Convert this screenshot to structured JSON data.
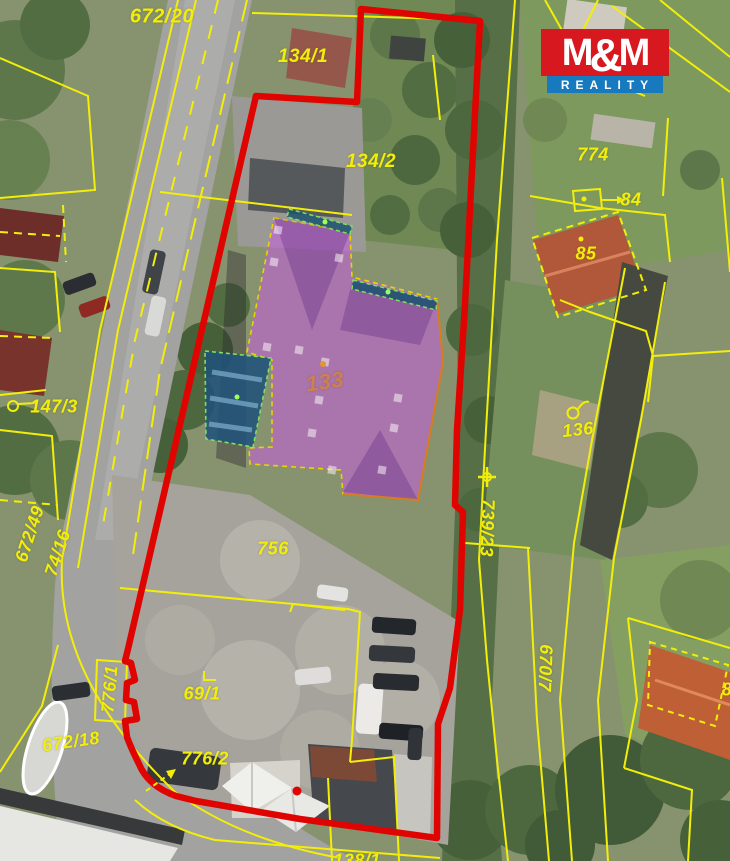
{
  "logo": {
    "m1": "M",
    "amp": "&",
    "m2": "M",
    "reality": "REALITY",
    "red": "#d7191f",
    "blue": "#1779be"
  },
  "map": {
    "colors": {
      "boundary_red": "#df0400",
      "cadastral_yellow": "#f2ee0a",
      "highlight_purple_fill": "rgba(199,92,224,0.55)",
      "highlight_purple_edge": "#e9d400",
      "highlight_orange_edge": "#d97b20",
      "terrace_fill": "rgba(26,84,112,0.85)",
      "terrace_edge": "#7fe060",
      "blue_building_fill": "rgba(32,82,122,0.88)",
      "label_orange": "#cf8050"
    },
    "parcel_labels": [
      {
        "id": "672-20",
        "text": "672/20",
        "x": 162,
        "y": 17,
        "rot": 0,
        "size": 20
      },
      {
        "id": "134-1",
        "text": "134/1",
        "x": 303,
        "y": 57,
        "rot": 0,
        "size": 19
      },
      {
        "id": "134-2",
        "text": "134/2",
        "x": 371,
        "y": 162,
        "rot": 0,
        "size": 19
      },
      {
        "id": "774",
        "text": "774",
        "x": 593,
        "y": 155,
        "rot": 0
      },
      {
        "id": "84",
        "text": "84",
        "x": 631,
        "y": 200,
        "rot": 0
      },
      {
        "id": "85",
        "text": "85",
        "x": 586,
        "y": 254,
        "rot": 0
      },
      {
        "id": "147-3",
        "text": "147/3",
        "x": 54,
        "y": 407,
        "rot": 0
      },
      {
        "id": "133",
        "text": "133",
        "x": 325,
        "y": 382,
        "rot": -8,
        "color": "#cf8050",
        "size": 22
      },
      {
        "id": "136",
        "text": "136",
        "x": 578,
        "y": 430,
        "rot": -6
      },
      {
        "id": "739-23",
        "text": "739/23",
        "x": 487,
        "y": 528,
        "rot": 92
      },
      {
        "id": "756",
        "text": "756",
        "x": 273,
        "y": 549,
        "rot": 0
      },
      {
        "id": "672-49",
        "text": "672/49",
        "x": 30,
        "y": 534,
        "rot": -72
      },
      {
        "id": "74-16",
        "text": "74/16",
        "x": 58,
        "y": 553,
        "rot": -72
      },
      {
        "id": "776-1",
        "text": "776/1",
        "x": 110,
        "y": 689,
        "rot": -85
      },
      {
        "id": "69-1",
        "text": "69/1",
        "x": 202,
        "y": 694,
        "rot": 0
      },
      {
        "id": "672-18",
        "text": "672/18",
        "x": 71,
        "y": 742,
        "rot": -8
      },
      {
        "id": "776-2",
        "text": "776/2",
        "x": 205,
        "y": 759,
        "rot": 0
      },
      {
        "id": "670-7",
        "text": "670/7",
        "x": 545,
        "y": 668,
        "rot": 92
      },
      {
        "id": "8-partial",
        "text": "8",
        "x": 727,
        "y": 690,
        "rot": 0
      },
      {
        "id": "138-1",
        "text": "138/1",
        "x": 357,
        "y": 861,
        "rot": 0
      }
    ],
    "highlights": {
      "main_building": {
        "points": "274,218 350,232 352,277 437,299 443,362 418,500 343,494 341,470 250,464 249,448 272,447 272,360 247,352",
        "orange_edge": "M437,299 L443,362 L418,500 L343,494",
        "facets": [
          "274,218 350,232 312,330",
          "352,282 437,301 420,345 340,330",
          "343,492 418,500 380,430"
        ],
        "dormers": [
          [
            278,
            230
          ],
          [
            274,
            262
          ],
          [
            339,
            258
          ],
          [
            267,
            347
          ],
          [
            299,
            350
          ],
          [
            325,
            362
          ],
          [
            319,
            400
          ],
          [
            398,
            398
          ],
          [
            394,
            428
          ],
          [
            312,
            433
          ],
          [
            382,
            470
          ],
          [
            332,
            470
          ]
        ]
      },
      "terraces": [
        "289,209 352,226 350,234 287,217",
        "353,280 437,301 436,310 352,289"
      ],
      "blue_building": {
        "points": "205,351 271,358 253,447 206,439",
        "stripes": [
          "M212,372 L262,380",
          "M210,398 L258,406",
          "M209,424 L252,430"
        ]
      }
    },
    "boundary": {
      "path": "M361,9 L480,21 L472,170 L465,305 L457,430 L455,505 L463,512 L460,610 L450,688 L438,724 L437,838 L300,819 L196,801 L176,796 Q148,786 139,764 Q131,748 127,737 L125,721 L137,719 L134,702 L126,700 L127,683 L135,680 L131,663 L125,661 L128,649 L256,96 L357,102 Z",
      "width": 6.5
    },
    "cadastral_lines": [
      {
        "d": "M0,58 L88,96 L95,190 L0,198"
      },
      {
        "d": "M0,232 L60,236",
        "dash": "8 6"
      },
      {
        "d": "M63,205 L66,262",
        "dash": "8 6"
      },
      {
        "d": "M0,268 L55,272 L60,332"
      },
      {
        "d": "M0,336 L52,338",
        "dash": "8 6"
      },
      {
        "d": "M0,395 L46,390"
      },
      {
        "d": "M0,430 L52,436 L58,520"
      },
      {
        "d": "M0,500 L58,505",
        "dash": "8 6"
      },
      {
        "d": "M178,0 L100,330 L62,560"
      },
      {
        "d": "M196,0 L118,330 L78,568"
      },
      {
        "d": "M218,0 L135,340 L103,525",
        "dash": "14 12"
      },
      {
        "d": "M247,0 L160,370 L133,555",
        "dash": "22 10"
      },
      {
        "d": "M62,560 C58,640 95,715 175,792 Q240,840 340,858"
      },
      {
        "d": "M0,772 L42,706 L58,645"
      },
      {
        "d": "M135,800 Q165,828 215,840 L440,858"
      },
      {
        "d": "M252,13 L480,20"
      },
      {
        "d": "M433,55 L440,120"
      },
      {
        "d": "M515,0 L497,240 L486,430 L479,560 L487,660 L497,760 L508,861"
      },
      {
        "d": "M545,0 L572,48 L602,78 L645,96"
      },
      {
        "d": "M598,0 L576,44"
      },
      {
        "d": "M612,6 L730,92"
      },
      {
        "d": "M660,0 L730,57"
      },
      {
        "d": "M530,196 L600,208 L665,215 L670,262"
      },
      {
        "d": "M668,118 L663,196"
      },
      {
        "d": "M722,178 L730,272"
      },
      {
        "d": "M532,238 L618,212 L646,290 L558,317 Z",
        "dash": "7 5"
      },
      {
        "d": "M560,300 L590,312 L622,323 L646,331 L653,356 L648,402"
      },
      {
        "d": "M653,356 L730,351"
      },
      {
        "d": "M625,268 L592,440 L574,543"
      },
      {
        "d": "M665,282 L641,420 L614,558"
      },
      {
        "d": "M465,543 L530,548"
      },
      {
        "d": "M528,548 L537,720 L549,861"
      },
      {
        "d": "M574,543 L560,700 L572,861"
      },
      {
        "d": "M614,558 L598,700 L608,861"
      },
      {
        "d": "M628,618 L730,648"
      },
      {
        "d": "M628,618 L637,700 L624,768"
      },
      {
        "d": "M624,768 L692,790 L688,861"
      },
      {
        "d": "M650,642 L728,665 L715,726 L648,705 Z",
        "dash": "6 5"
      },
      {
        "d": "M120,588 L348,609"
      },
      {
        "d": "M290,612 L293,604 L345,610"
      },
      {
        "d": "M348,609 L360,612 L352,740 L350,762"
      },
      {
        "d": "M350,762 L394,757 L399,861"
      },
      {
        "d": "M328,778 L332,861"
      },
      {
        "d": "M160,192 L352,215"
      },
      {
        "d": "M97,660 L127,662 L125,722 L95,720 Z"
      }
    ],
    "symbols": [
      {
        "type": "circle",
        "x": 13,
        "y": 406,
        "r": 5
      },
      {
        "type": "line",
        "d": "M18,404 L36,403"
      },
      {
        "type": "circle",
        "x": 573,
        "y": 413,
        "r": 5.5
      },
      {
        "type": "line",
        "d": "M578,409 Q584,400 589,402"
      },
      {
        "type": "cross-circle",
        "x": 487,
        "y": 477
      },
      {
        "type": "box",
        "points": "573,191 600,189 602,209 575,211"
      },
      {
        "type": "dot",
        "x": 584,
        "y": 199,
        "r": 2.5
      },
      {
        "type": "arrow",
        "d": "M602,200 L617,200",
        "head": "617,196 626,200 617,204"
      },
      {
        "type": "arrow",
        "d": "M146,791 L171,773",
        "head": "176,769 166,771 171,779",
        "dash": "5 4"
      },
      {
        "type": "corner",
        "d": "M204,671 L204,680 L216,680"
      },
      {
        "type": "dot",
        "x": 581,
        "y": 239,
        "r": 2.5
      },
      {
        "type": "dot",
        "x": 323,
        "y": 364,
        "r": 3,
        "color": "#e2962e"
      },
      {
        "type": "dot",
        "x": 297,
        "y": 791,
        "r": 4.5,
        "color": "#df0400"
      },
      {
        "type": "dot",
        "x": 325,
        "y": 222,
        "r": 2.5,
        "color": "#9dff57"
      },
      {
        "type": "dot",
        "x": 388,
        "y": 292,
        "r": 2.5,
        "color": "#9dff57"
      },
      {
        "type": "dot",
        "x": 237,
        "y": 397,
        "r": 2.5,
        "color": "#9dff57"
      }
    ]
  }
}
